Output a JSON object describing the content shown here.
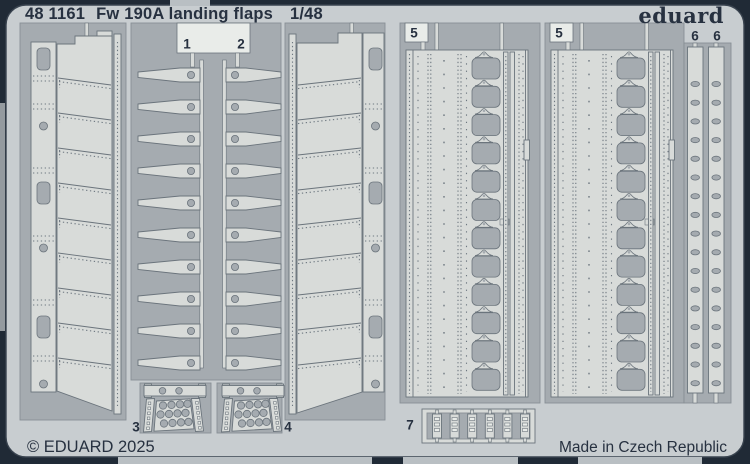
{
  "header": {
    "catalog": "48 1161",
    "title": "Fw 190A landing flaps",
    "scale": "1/48",
    "brand": "eduard"
  },
  "footer": {
    "copyright": "© EDUARD 2025",
    "made_in": "Made in Czech Republic"
  },
  "parts": [
    {
      "label": "1"
    },
    {
      "label": "2"
    },
    {
      "label": "3"
    },
    {
      "label": "4"
    },
    {
      "label": "5"
    },
    {
      "label": "5"
    },
    {
      "label": "6"
    },
    {
      "label": "6"
    },
    {
      "label": "7"
    }
  ],
  "colors": {
    "background": "#202a36",
    "sheet": "#c8cdd0",
    "etched": "#a5abb0",
    "part": "#d8dbd9",
    "bright": "#e9ece9",
    "ink": "#273140",
    "edge": "#6b747c",
    "tab": "#b9bfc3"
  }
}
